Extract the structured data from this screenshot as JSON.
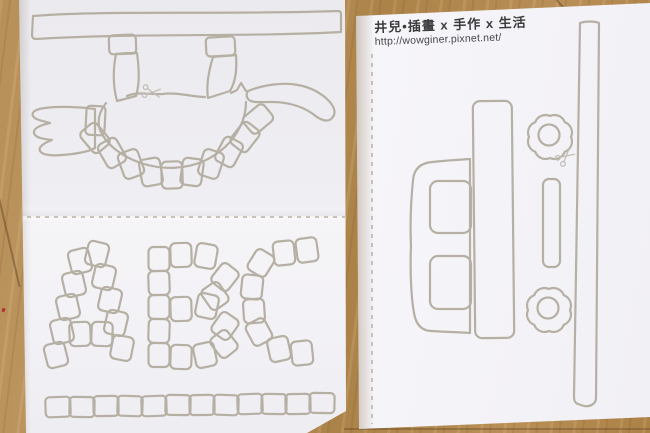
{
  "watermark": {
    "title": "井兒•插畫 x 手作 x 生活",
    "url": "http://wowginer.pixnet.net/"
  },
  "colors": {
    "outline": "#b6b0a4",
    "paper": "#f2f1f5",
    "wood": "#b58d55",
    "ink": "#3b3b3b"
  },
  "left_sheet": {
    "top_template": "dinosaur-cutout",
    "bottom_template": "letter-blocks",
    "letters": [
      "A",
      "B",
      "C"
    ],
    "block_size": {
      "letter": [
        21,
        24
      ],
      "row": [
        25,
        20
      ],
      "plate": [
        21,
        27
      ]
    },
    "blocks": {
      "A": [
        [
          56,
          355,
          -14
        ],
        [
          62,
          331,
          -13
        ],
        [
          68,
          307,
          -13
        ],
        [
          74,
          284,
          -13
        ],
        [
          80,
          261,
          -14
        ],
        [
          97,
          254,
          14
        ],
        [
          104,
          277,
          13
        ],
        [
          110,
          300,
          13
        ],
        [
          116,
          323,
          13
        ],
        [
          122,
          348,
          11
        ],
        [
          80,
          334,
          -2
        ],
        [
          102,
          334,
          2
        ]
      ],
      "B": [
        [
          159,
          259,
          0
        ],
        [
          159,
          283,
          -2
        ],
        [
          159,
          307,
          0
        ],
        [
          159,
          331,
          2
        ],
        [
          159,
          355,
          0
        ],
        [
          181,
          255,
          -2
        ],
        [
          206,
          256,
          10
        ],
        [
          225,
          277,
          38
        ],
        [
          215,
          296,
          -35
        ],
        [
          181,
          309,
          -2
        ],
        [
          207,
          306,
          12
        ],
        [
          225,
          326,
          35
        ],
        [
          224,
          344,
          -38
        ],
        [
          205,
          355,
          -12
        ],
        [
          181,
          357,
          2
        ]
      ],
      "C": [
        [
          284,
          253,
          -6
        ],
        [
          307,
          250,
          -8
        ],
        [
          261,
          263,
          32
        ],
        [
          252,
          287,
          6
        ],
        [
          254,
          311,
          -4
        ],
        [
          259,
          332,
          -28
        ],
        [
          279,
          349,
          -12
        ],
        [
          302,
          353,
          -6
        ]
      ],
      "row": [
        [
          58,
          407,
          -2
        ],
        [
          82,
          407,
          1
        ],
        [
          106,
          406,
          -1
        ],
        [
          130,
          406,
          2
        ],
        [
          154,
          406,
          -2
        ],
        [
          178,
          405,
          1
        ],
        [
          202,
          405,
          -1
        ],
        [
          226,
          405,
          2
        ],
        [
          250,
          404,
          -2
        ],
        [
          274,
          404,
          1
        ],
        [
          298,
          404,
          -1
        ],
        [
          322,
          403,
          1
        ]
      ]
    },
    "plates": [
      [
        95,
        138,
        -40
      ],
      [
        112,
        153,
        -30
      ],
      [
        131,
        164,
        -20
      ],
      [
        151,
        172,
        -10
      ],
      [
        172,
        175,
        -2
      ],
      [
        192,
        172,
        8
      ],
      [
        211,
        164,
        18
      ],
      [
        229,
        152,
        28
      ],
      [
        245,
        137,
        38
      ],
      [
        258,
        119,
        50
      ]
    ]
  },
  "right_sheet": {
    "template": "truck-with-flower-wheels",
    "wheels": [
      {
        "cx": 550,
        "cy": 137
      },
      {
        "cx": 549,
        "cy": 310
      }
    ]
  }
}
